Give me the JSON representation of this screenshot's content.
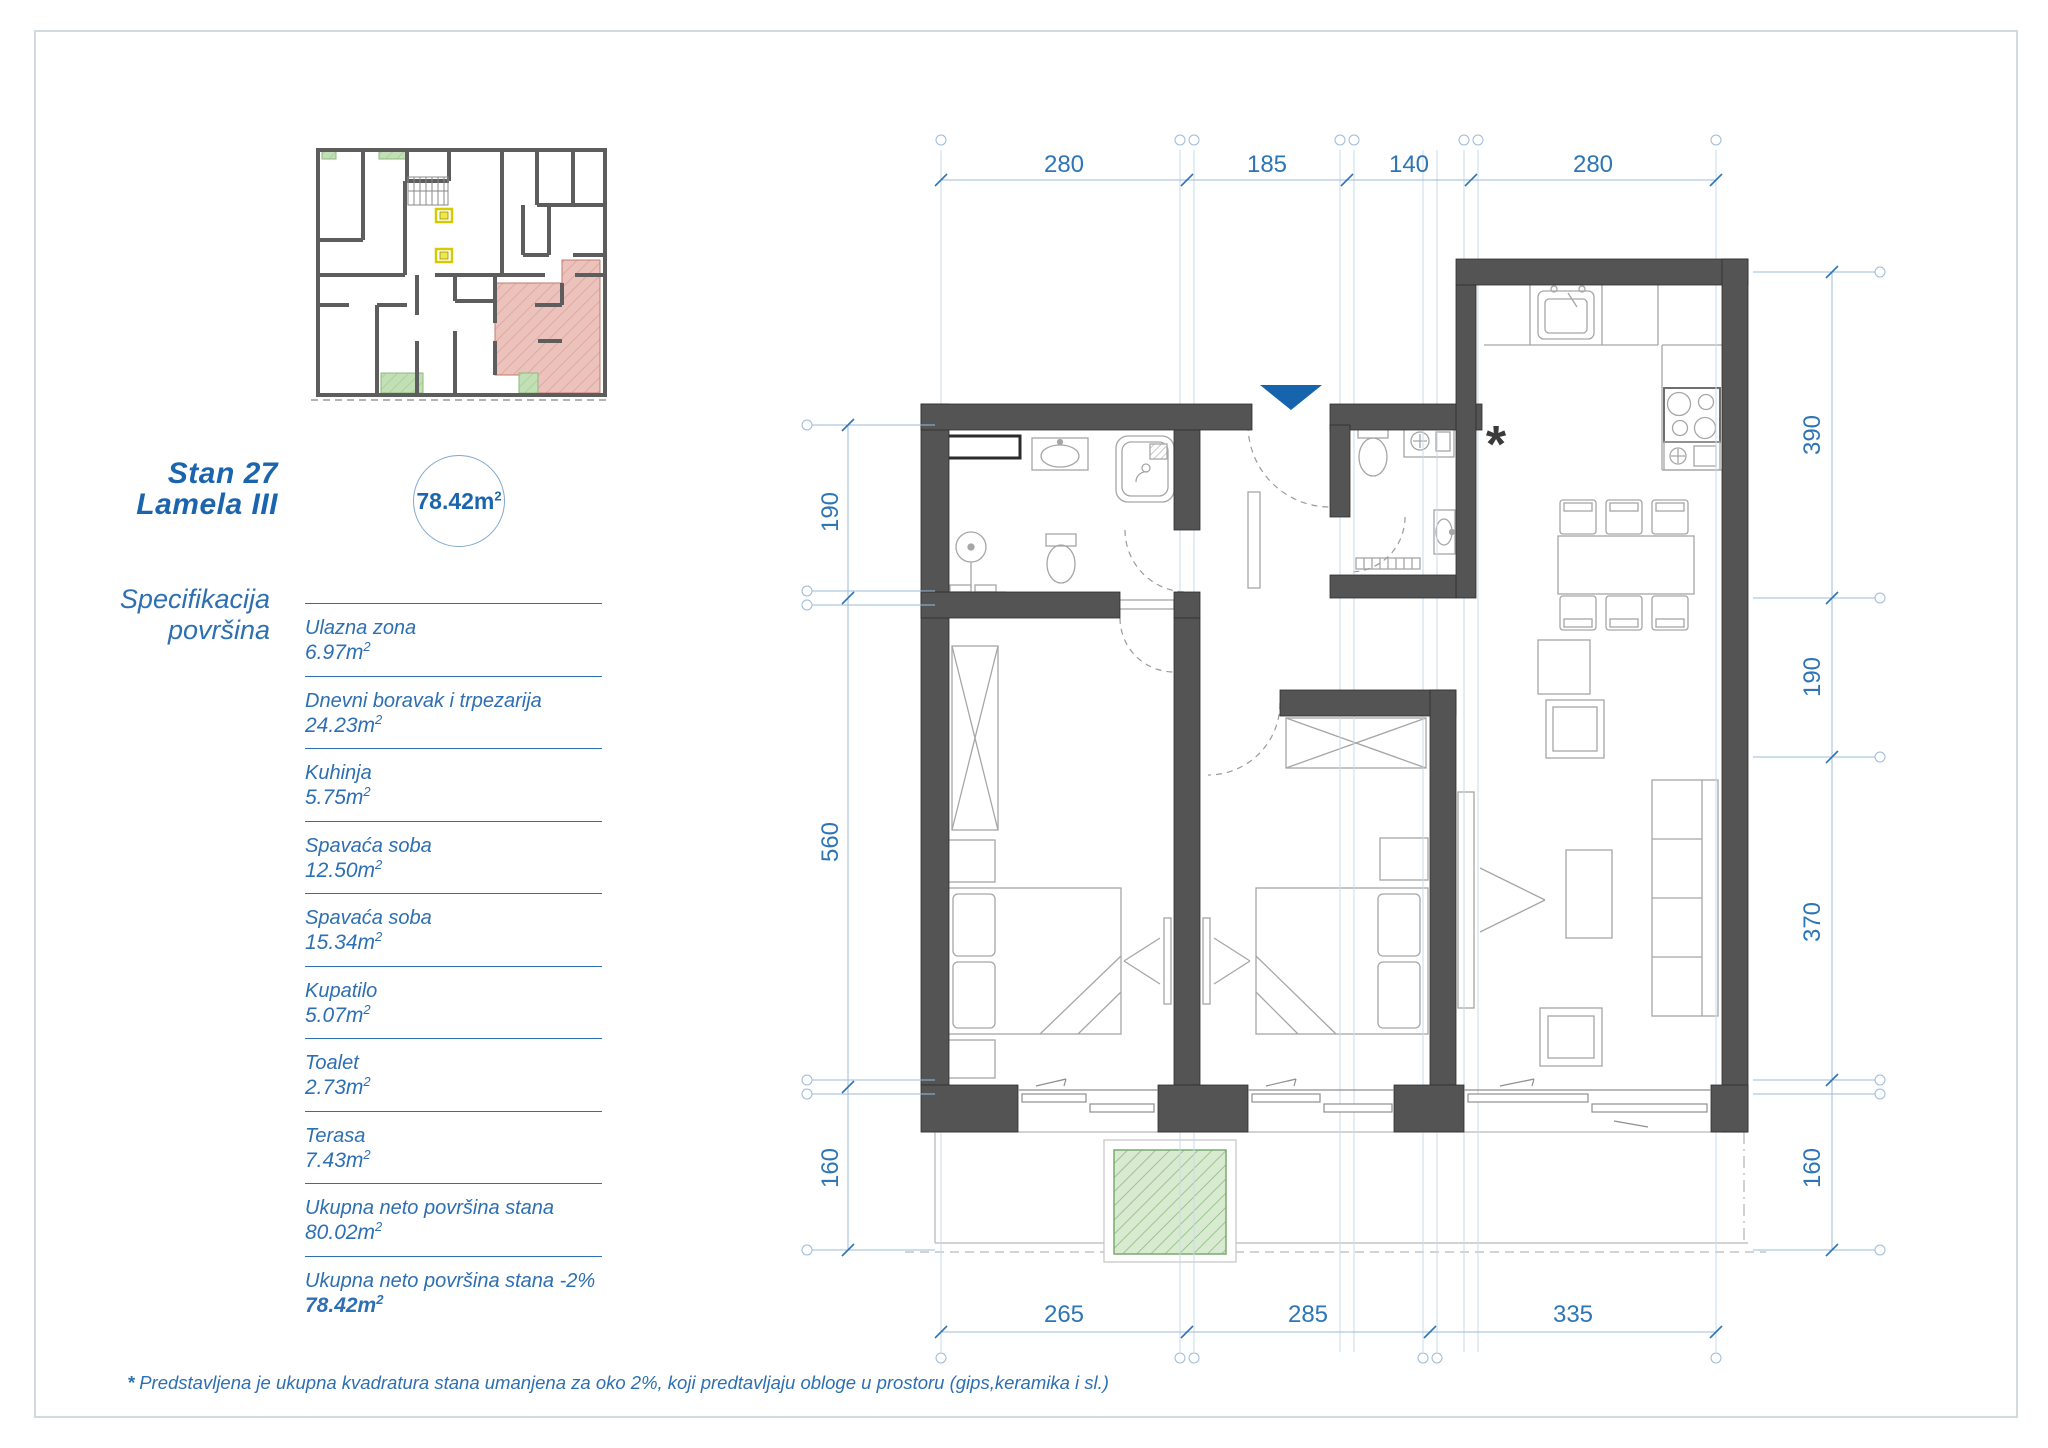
{
  "title": {
    "line1": "Stan 27",
    "line2": "Lamela III"
  },
  "badge": {
    "value": "78.42m",
    "sup": "2"
  },
  "spec": {
    "heading1": "Specifikacija",
    "heading2": "površina",
    "items": [
      {
        "label": "Ulazna zona",
        "value": "6.97m",
        "sup": "2"
      },
      {
        "label": "Dnevni boravak i trpezarija",
        "value": "24.23m",
        "sup": "2"
      },
      {
        "label": "Kuhinja",
        "value": "5.75m",
        "sup": "2"
      },
      {
        "label": "Spavaća soba",
        "value": "12.50m",
        "sup": "2"
      },
      {
        "label": "Spavaća soba",
        "value": "15.34m",
        "sup": "2"
      },
      {
        "label": "Kupatilo",
        "value": "5.07m",
        "sup": "2"
      },
      {
        "label": "Toalet",
        "value": "2.73m",
        "sup": "2"
      },
      {
        "label": "Terasa",
        "value": "7.43m",
        "sup": "2"
      },
      {
        "label": "Ukupna neto površina stana",
        "value": "80.02m",
        "sup": "2"
      },
      {
        "label": "Ukupna neto površina stana -2%",
        "value": "78.42m",
        "sup": "2"
      }
    ]
  },
  "plan": {
    "asterisk": "*",
    "dims": {
      "top": [
        "280",
        "185",
        "140",
        "280"
      ],
      "left": [
        "190",
        "560",
        "160"
      ],
      "right": [
        "390",
        "190",
        "370",
        "160"
      ],
      "bottom": [
        "265",
        "285",
        "335"
      ]
    }
  },
  "footnote": {
    "marker": "*",
    "text": "Predstavljena je ukupna kvadratura stana umanjena za oko 2%, koji predtavljaju obloge u prostoru (gips,keramika i sl.)"
  },
  "colors": {
    "accent_blue": "#1b65af",
    "dim_blue": "#2e75b6",
    "wall_gray": "#545454",
    "apartment_pink": "#ecc3bc",
    "terrace_green": "#bedcb2",
    "elevator_yellow": "#f4ef4e"
  }
}
